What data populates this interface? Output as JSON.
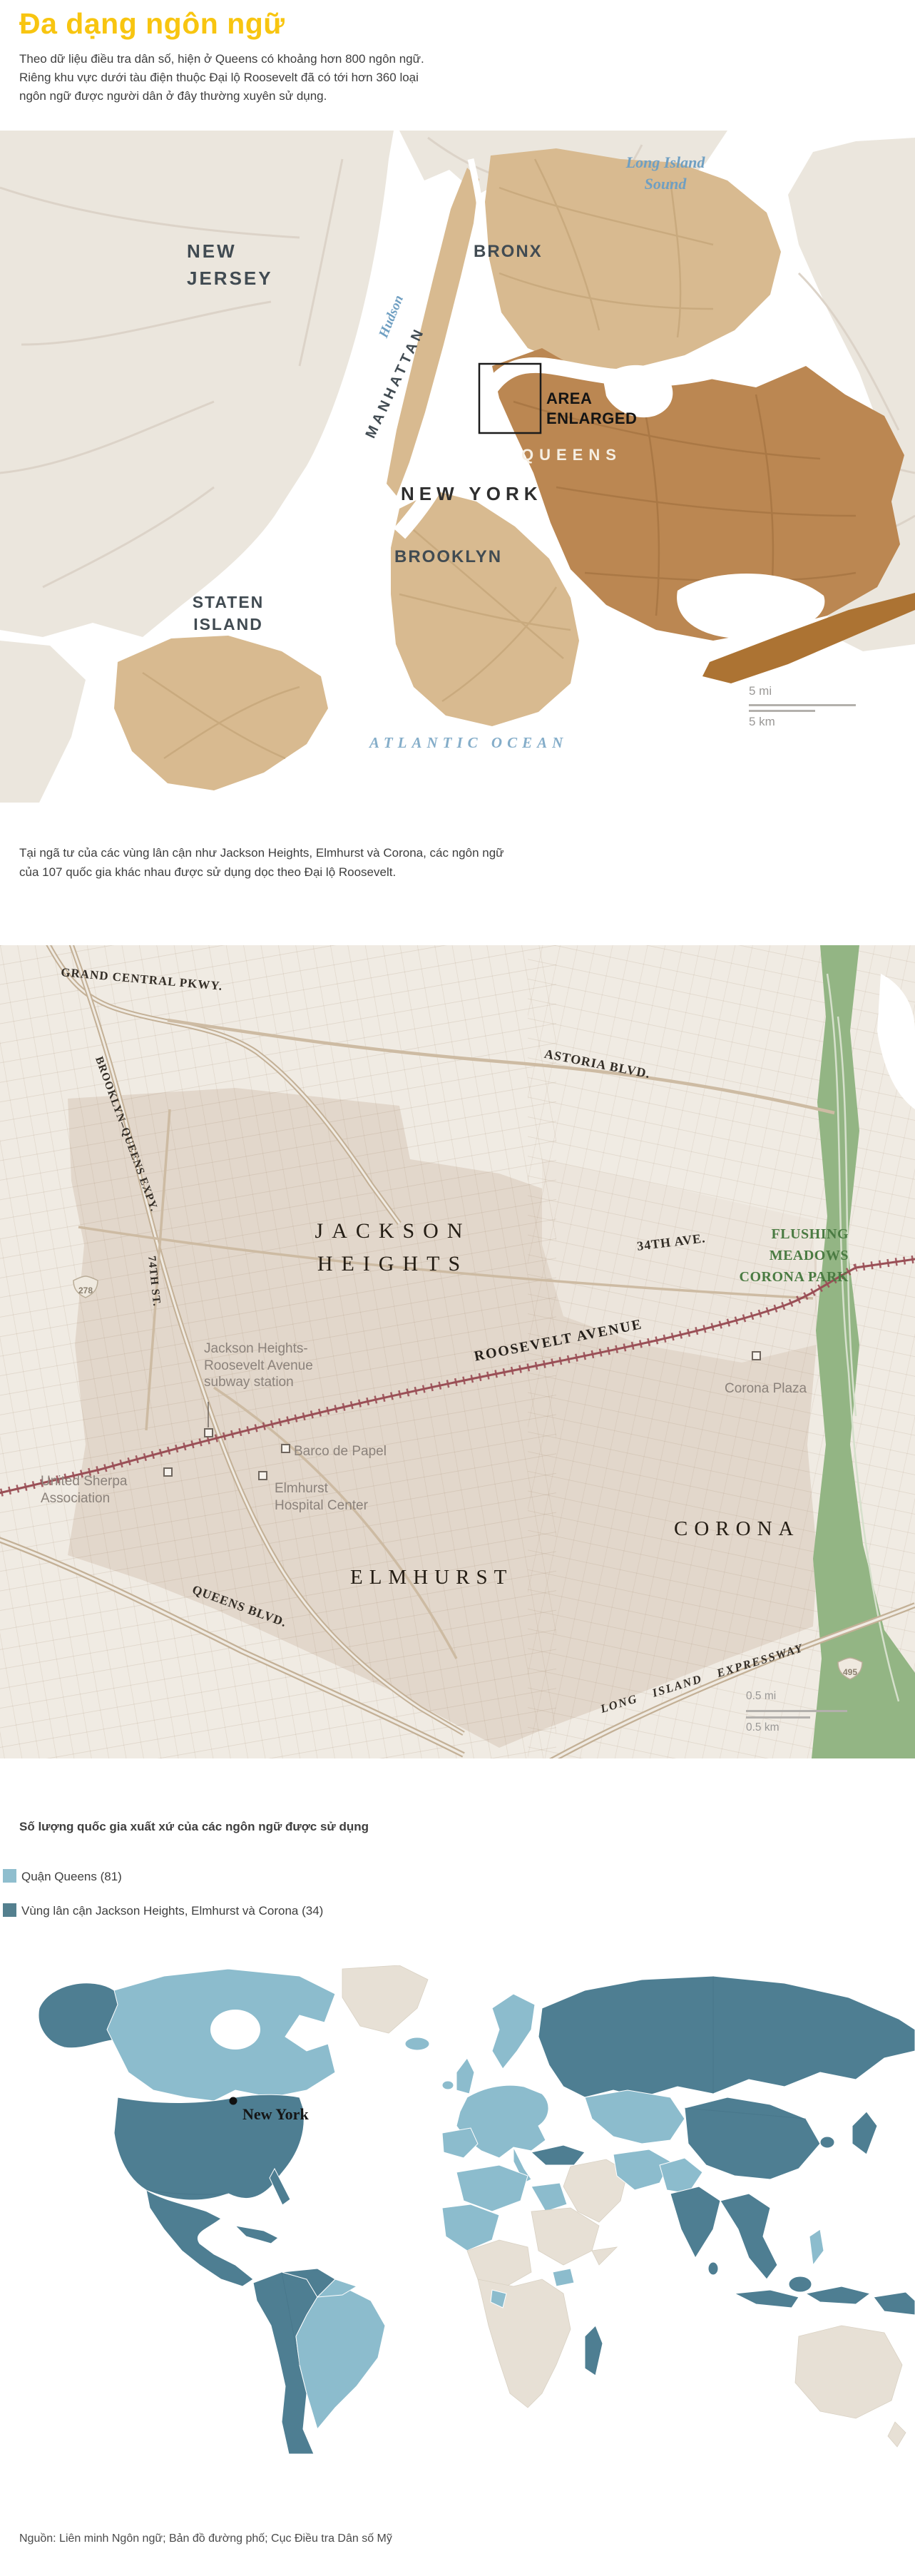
{
  "page": {
    "title": "Đa dạng ngôn ngữ",
    "intro_lines": [
      "Theo dữ liệu điều tra dân số, hiện ở Queens có khoảng hơn 800 ngôn ngữ.",
      "Riêng khu vực dưới tàu điện thuộc Đại lộ Roosevelt đã có tới hơn 360 loại",
      "ngôn ngữ được người dân ở đây thường xuyên sử dụng."
    ],
    "middle_lines": [
      "Tại ngã tư của các vùng lân cận như Jackson Heights, Elmhurst và Corona, các ngôn ngữ",
      "của 107 quốc gia khác nhau được sử dụng dọc theo Đại lộ Roosevelt."
    ],
    "source": "Nguồn: Liên minh Ngôn ngữ; Bản đồ đường phố; Cục Điều tra Dân số Mỹ",
    "accent_color": "#F8C510"
  },
  "locator_map": {
    "labels": {
      "new_jersey_1": "NEW",
      "new_jersey_2": "JERSEY",
      "bronx": "BRONX",
      "long_island_sound_1": "Long Island",
      "long_island_sound_2": "Sound",
      "hudson": "Hudson",
      "manhattan": "MANHATTAN",
      "area_enlarged_1": "AREA",
      "area_enlarged_2": "ENLARGED",
      "queens": "QUEENS",
      "new_york": "NEW YORK",
      "brooklyn": "BROOKLYN",
      "staten_island_1": "STATEN",
      "staten_island_2": "ISLAND",
      "atlantic_ocean": "ATLANTIC OCEAN"
    },
    "scale": {
      "mi": "5 mi",
      "km": "5 km"
    }
  },
  "street_map": {
    "roads": {
      "grand_central": "GRAND CENTRAL PKWY.",
      "bqe": "BROOKLYN–QUEENS EXPY.",
      "astoria": "ASTORIA BLVD.",
      "st74": "74TH ST.",
      "ave34": "34TH AVE.",
      "roosevelt": "ROOSEVELT AVENUE",
      "queens_blvd": "QUEENS BLVD.",
      "lie": "LONG ISLAND EXPRESSWAY"
    },
    "neighborhoods": {
      "jackson_heights_1": "JACKSON",
      "jackson_heights_2": "HEIGHTS",
      "elmhurst": "ELMHURST",
      "corona": "CORONA"
    },
    "park_lines": [
      "FLUSHING",
      "MEADOWS",
      "CORONA PARK"
    ],
    "pois": {
      "subway_lines": [
        "Jackson Heights-",
        "Roosevelt Avenue",
        "subway station"
      ],
      "corona_plaza": "Corona Plaza",
      "barco": "Barco de Papel",
      "sherpa_lines": [
        "United Sherpa",
        "Association"
      ],
      "hospital_lines": [
        "Elmhurst",
        "Hospital Center"
      ]
    },
    "shields": {
      "i278": "278",
      "i495": "495"
    },
    "scale": {
      "mi": "0.5 mi",
      "km": "0.5 km"
    }
  },
  "legend": {
    "title": "Số lượng quốc gia xuất xứ của các ngôn ngữ được sử dụng",
    "items": [
      {
        "label": "Quận Queens (81)",
        "color": "#8FBECE"
      },
      {
        "label": "Vùng lân cận Jackson Heights, Elmhurst và Corona (34)",
        "color": "#54808F"
      }
    ]
  },
  "world_map": {
    "marker_label": "New York",
    "color_queens": "#8CBCCD",
    "color_neighborhood": "#4E7E92",
    "color_none": "#E7E0D5"
  }
}
